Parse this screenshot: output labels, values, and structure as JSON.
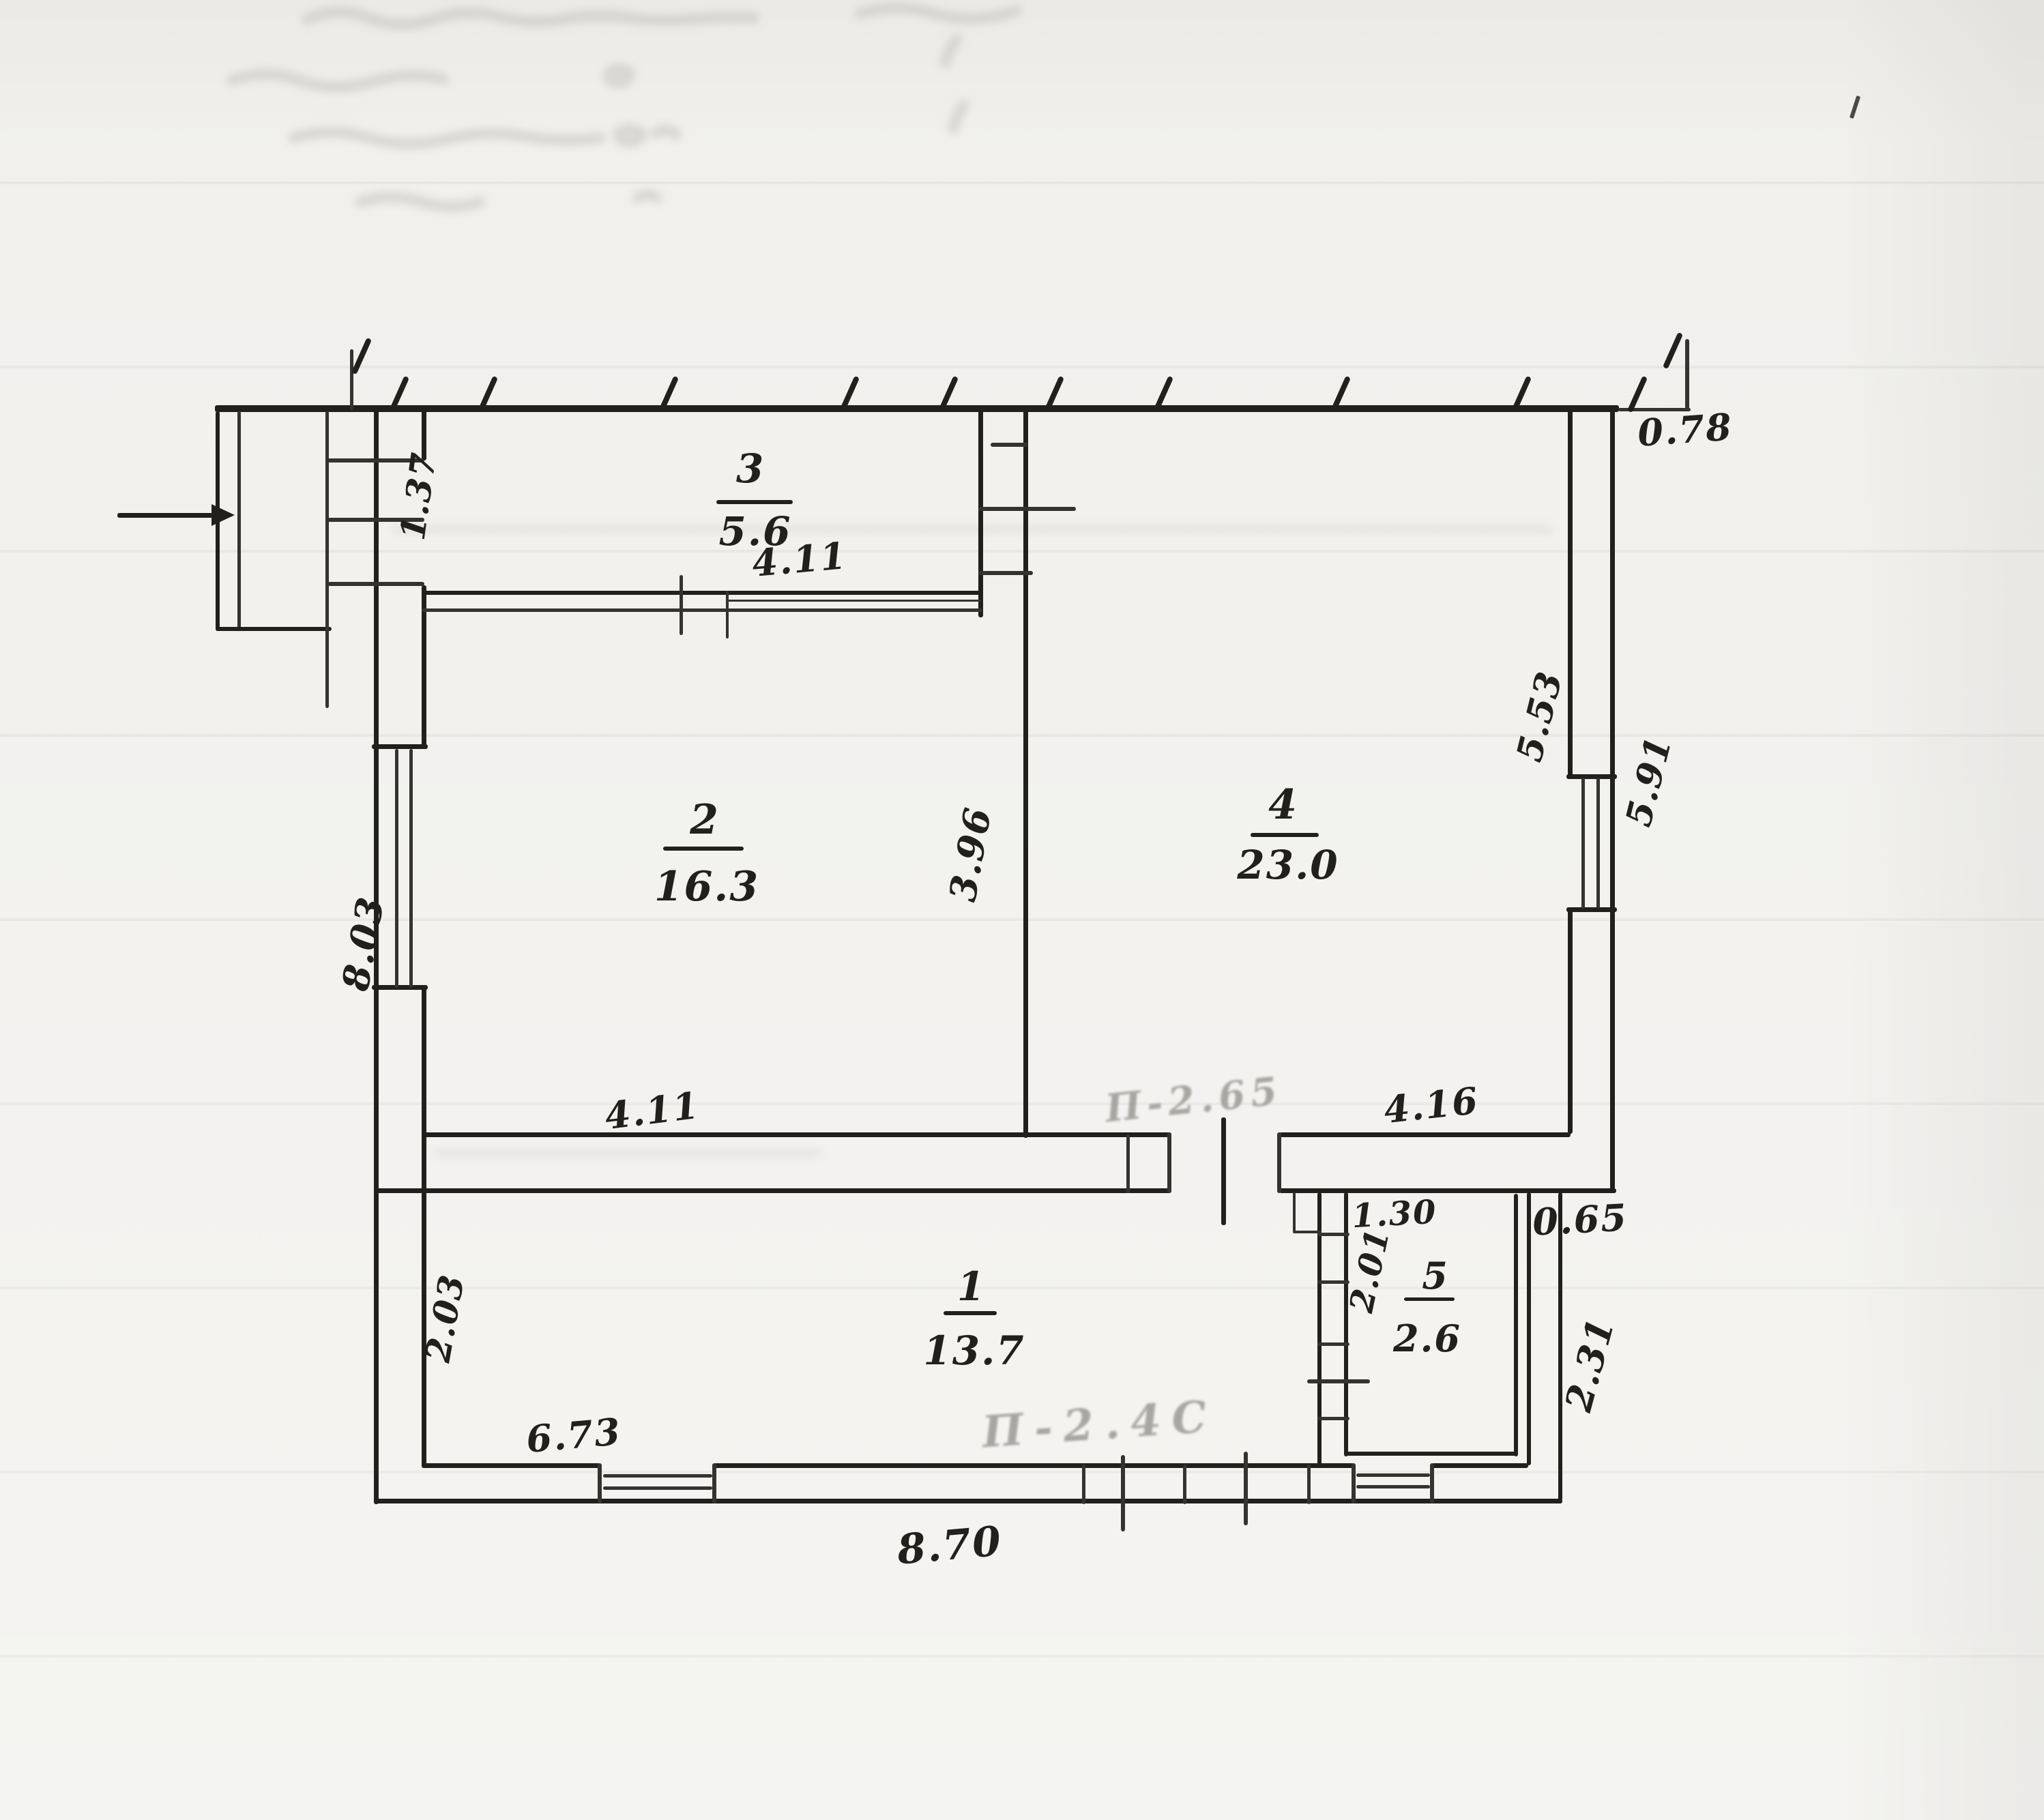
{
  "document": {
    "type": "hand-drawn floor plan sketch",
    "units": "m"
  },
  "rooms": [
    {
      "number": "1",
      "area": "13.7"
    },
    {
      "number": "2",
      "area": "16.3"
    },
    {
      "number": "3",
      "area": "5.6"
    },
    {
      "number": "4",
      "area": "23.0"
    },
    {
      "number": "5",
      "area": "2.6"
    }
  ],
  "dimensions": {
    "porch_entry_width": "1.37",
    "room3_bottom_width": "4.11",
    "room2_right_height": "3.96",
    "room2_bottom_width": "4.11",
    "room4_bottom_width": "4.16",
    "room4_right_height": "5.53",
    "right_wall_outside": "5.91",
    "top_right_offset": "0.78",
    "left_wall_outside": "8.03",
    "room1_left_height": "2.03",
    "room1_bottom_width": "6.73",
    "bottom_outside_width": "8.70",
    "room5_top_width": "1.30",
    "room5_left_height": "2.01",
    "right_bottom_offset": "0.65",
    "right_bottom_height": "2.31"
  },
  "pencil_notes": {
    "door_to_room4": "П-2.65",
    "door_to_outside": "П-2.4С"
  }
}
